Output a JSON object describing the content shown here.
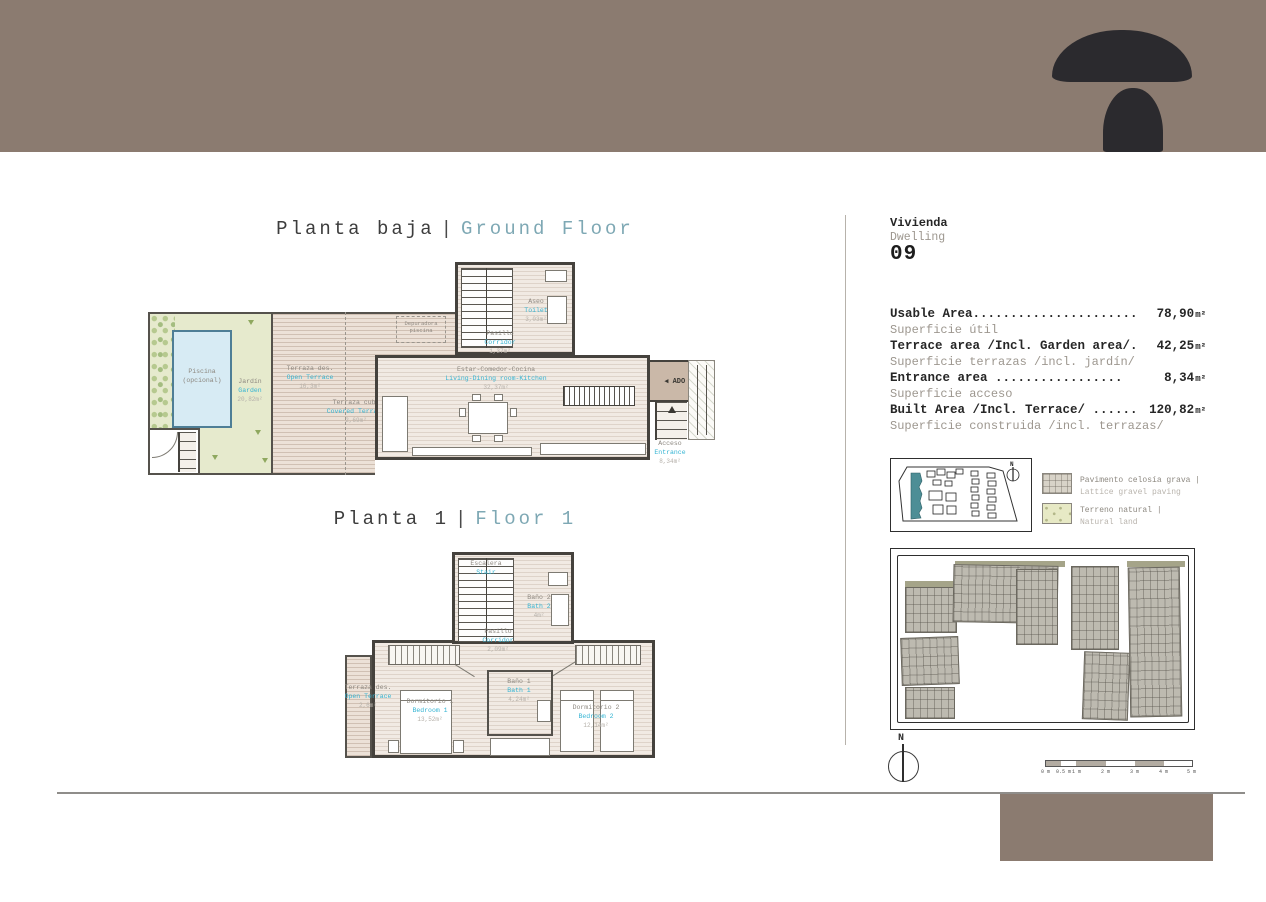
{
  "titles": {
    "ground": {
      "es": "Planta baja",
      "sep": "|",
      "en": "Ground Floor"
    },
    "first": {
      "es": "Planta 1",
      "sep": "|",
      "en": "Floor 1"
    }
  },
  "dwelling": {
    "label_es": "Vivienda",
    "label_en": "Dwelling",
    "number": "09"
  },
  "areas": [
    {
      "en": "Usable Area......................",
      "value": "78,90",
      "unit": "m²",
      "es": "Superficie útil"
    },
    {
      "en": "Terrace area /Incl. Garden area/.",
      "value": "42,25",
      "unit": "m²",
      "es": "Superficie terrazas /incl. jardín/"
    },
    {
      "en": "Entrance area  .................",
      "value": "8,34",
      "unit": "m²",
      "es": "Superficie acceso"
    },
    {
      "en": "Built Area /Incl. Terrace/ ......",
      "value": "120,82",
      "unit": "m²",
      "es": "Superficie construida /incl. terrazas/"
    }
  ],
  "ground_rooms": {
    "piscina": {
      "es": "Piscina",
      "es2": "(opcional)"
    },
    "jardin": {
      "es": "Jardín",
      "en": "Garden",
      "area": "20,82m²"
    },
    "terraza_des": {
      "es": "Terraza des.",
      "en": "Open Terrace",
      "area": "16,3m²"
    },
    "terraza_cub": {
      "es": "Terraza cub.",
      "en": "Covered Terrace",
      "area": "2,69m²"
    },
    "depuradora": {
      "line1": "Depuradora",
      "line2": "piscina"
    },
    "aseo": {
      "es": "Aseo",
      "en": "Toilet",
      "area": "3,03m²"
    },
    "pasillo": {
      "es": "Pasillo",
      "en": "Corridor",
      "area": "1,37m²"
    },
    "estar": {
      "es": "Estar-Comedor-Cocina",
      "en": "Living-Dining room-Kitchen",
      "area": "32,37m²"
    },
    "acceso": {
      "es": "Acceso",
      "en": "Entrance",
      "area": "8,34m²"
    },
    "ado": {
      "label": "◀ ADO 09"
    }
  },
  "first_rooms": {
    "escalera": {
      "es": "Escalera",
      "en": "Stair"
    },
    "bano2": {
      "es": "Baño 2",
      "en": "Bath 2",
      "area": "4m²"
    },
    "pasillo": {
      "es": "Pasillo",
      "en": "Corridor",
      "area": "2,09m²"
    },
    "terraza": {
      "es": "Terraza des.",
      "en": "Open Terrace",
      "area": "2,6m²"
    },
    "dorm1": {
      "es": "Dormitorio 1",
      "en": "Bedroom 1",
      "area": "13,52m²"
    },
    "bano1": {
      "es": "Baño 1",
      "en": "Bath 1",
      "area": "4,24m²"
    },
    "dorm2": {
      "es": "Dormitorio 2",
      "en": "Bedroom 2",
      "area": "12,14m²"
    }
  },
  "legend": {
    "items": [
      {
        "es": "Pavimento celosía grava |",
        "en": "Lattice gravel paving"
      },
      {
        "es": "Terreno natural |",
        "en": "Natural land"
      }
    ]
  },
  "compass": {
    "label": "N"
  },
  "minimap": {
    "compass": "N"
  },
  "scalebar": {
    "labels": [
      "0 m",
      "0.5 m",
      "1 m",
      "2 m",
      "3 m",
      "4 m",
      "5 m"
    ]
  },
  "colors": {
    "band": "#8b7b70",
    "accent_cyan": "#34b4d3",
    "accent_teal": "#7ea8b4",
    "logo": "#2b2a2e"
  }
}
